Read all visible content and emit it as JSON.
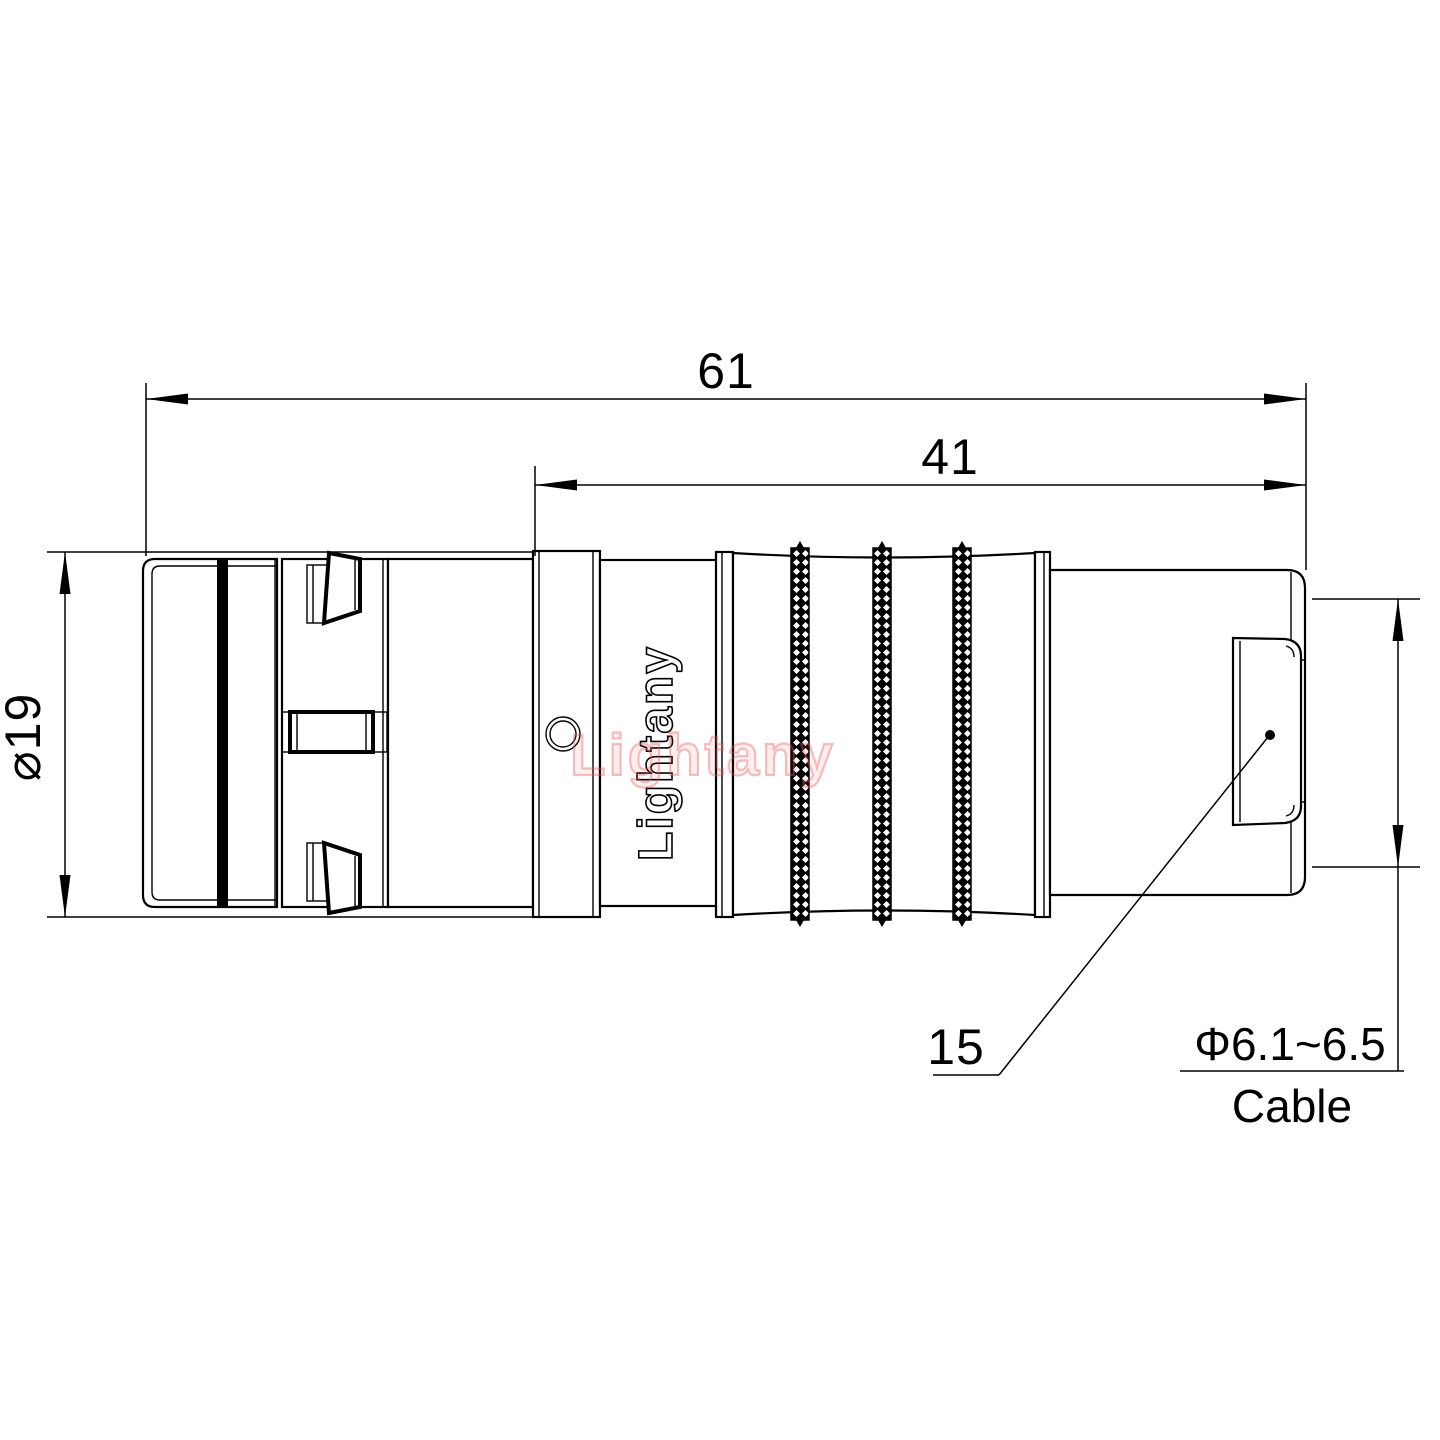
{
  "drawing": {
    "brand_engraving": "Lightany",
    "watermark": "Lightany",
    "dims": {
      "overall_length": "61",
      "rear_length": "41",
      "outer_diameter": "⌀19",
      "leader_ref": "15",
      "cable_diameter": "Φ6.1~6.5",
      "cable_caption": "Cable"
    },
    "colors": {
      "line": "#000000",
      "watermark_red": "#e8565c",
      "background": "#ffffff"
    }
  }
}
